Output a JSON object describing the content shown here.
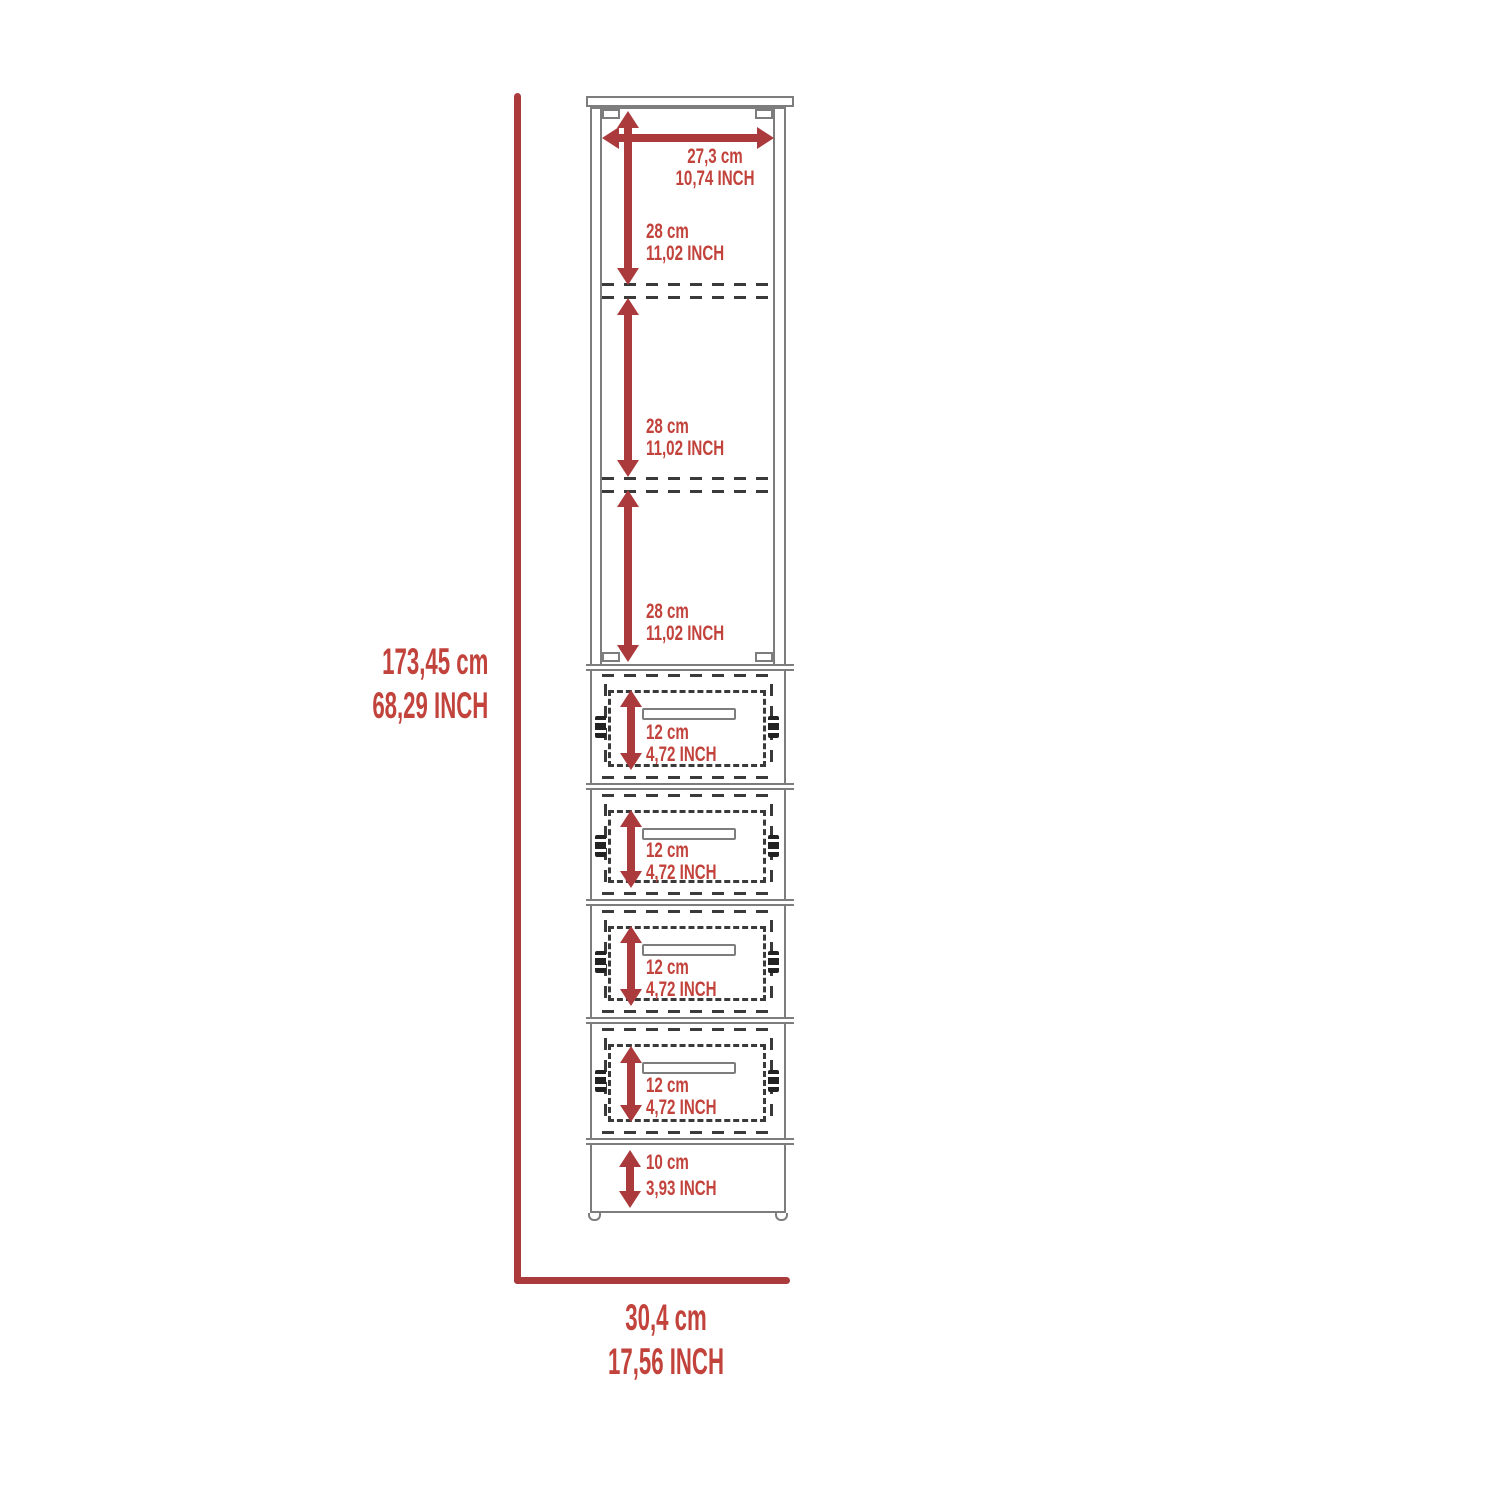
{
  "colors": {
    "dim_red": "#aa3a3c",
    "text_red": "#c2423c",
    "outline": "#7d7d7d",
    "dash": "#3a3a3a",
    "hardware": "#222222",
    "bg": "#ffffff"
  },
  "dimensions": {
    "overall_height": {
      "cm": "173,45 cm",
      "inch": "68,29 INCH"
    },
    "overall_width": {
      "cm": "30,4 cm",
      "inch": "17,56 INCH"
    },
    "interior_width": {
      "cm": "27,3 cm",
      "inch": "10,74 INCH"
    },
    "shelves": [
      {
        "cm": "28 cm",
        "inch": "11,02 INCH"
      },
      {
        "cm": "28 cm",
        "inch": "11,02 INCH"
      },
      {
        "cm": "28 cm",
        "inch": "11,02 INCH"
      }
    ],
    "drawers": [
      {
        "cm": "12 cm",
        "inch": "4,72 INCH"
      },
      {
        "cm": "12 cm",
        "inch": "4,72 INCH"
      },
      {
        "cm": "12 cm",
        "inch": "4,72 INCH"
      },
      {
        "cm": "12 cm",
        "inch": "4,72 INCH"
      }
    ],
    "base": {
      "cm": "10 cm",
      "inch": "3,93 INCH"
    }
  }
}
